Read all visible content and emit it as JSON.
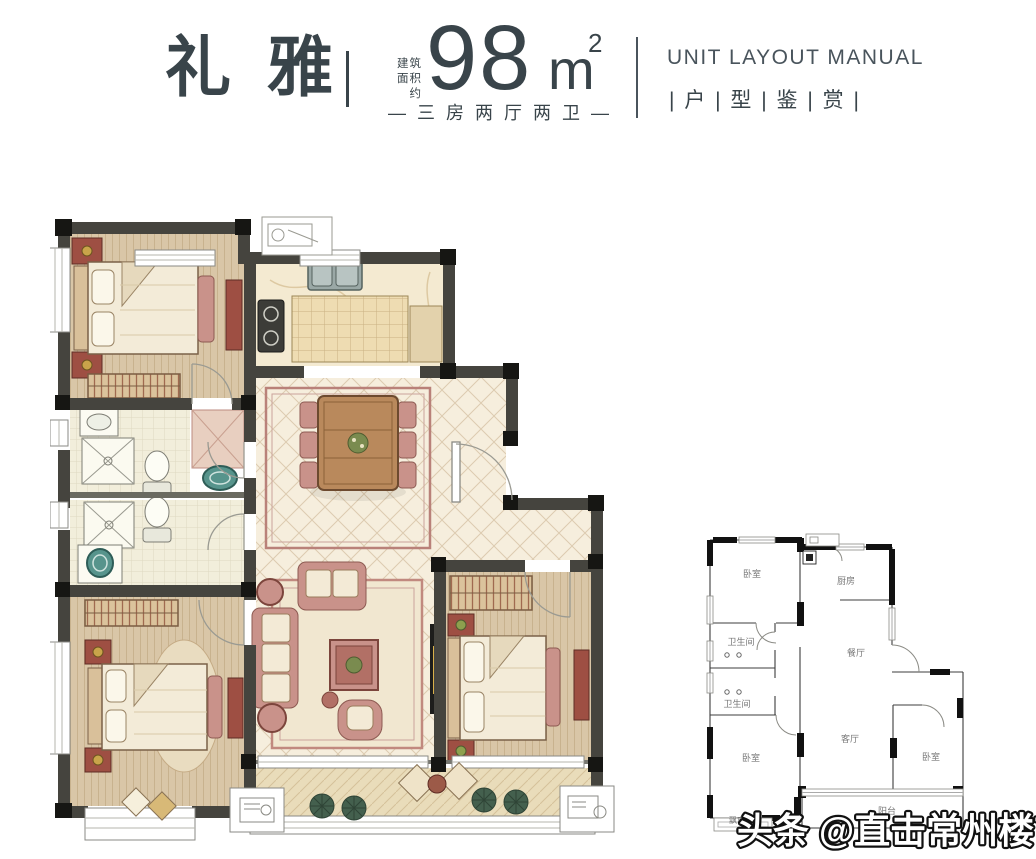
{
  "header": {
    "title": "礼雅",
    "area_label_line1": "建筑",
    "area_label_line2": "面积约",
    "area_value": "98",
    "area_unit": "m",
    "area_exponent": "2",
    "layout_spec": "— 三 房 两 厅 两 卫 —",
    "en_title": "UNIT LAYOUT MANUAL",
    "cn_subtitle": "| 户 | 型 | 鉴 | 赏 |"
  },
  "mini_plan": {
    "rooms": [
      {
        "label": "卧室"
      },
      {
        "label": "厨房"
      },
      {
        "label": "卫生间"
      },
      {
        "label": "餐厅"
      },
      {
        "label": "卫生间"
      },
      {
        "label": "卧室"
      },
      {
        "label": "客厅"
      },
      {
        "label": "卧室"
      },
      {
        "label": "飘窗"
      },
      {
        "label": "阳台"
      }
    ]
  },
  "watermark": {
    "text": "头条 @直击常州楼市"
  },
  "colors": {
    "heading": "#39444a",
    "wall_dark": "#45443e",
    "wall_black": "#161613",
    "wood_floor": "#d9c6a7",
    "tile_floor": "#f6eedd",
    "accent_pink": "#c9928a",
    "dark_red": "#9e4f43",
    "teal_fixture": "#57948c"
  }
}
